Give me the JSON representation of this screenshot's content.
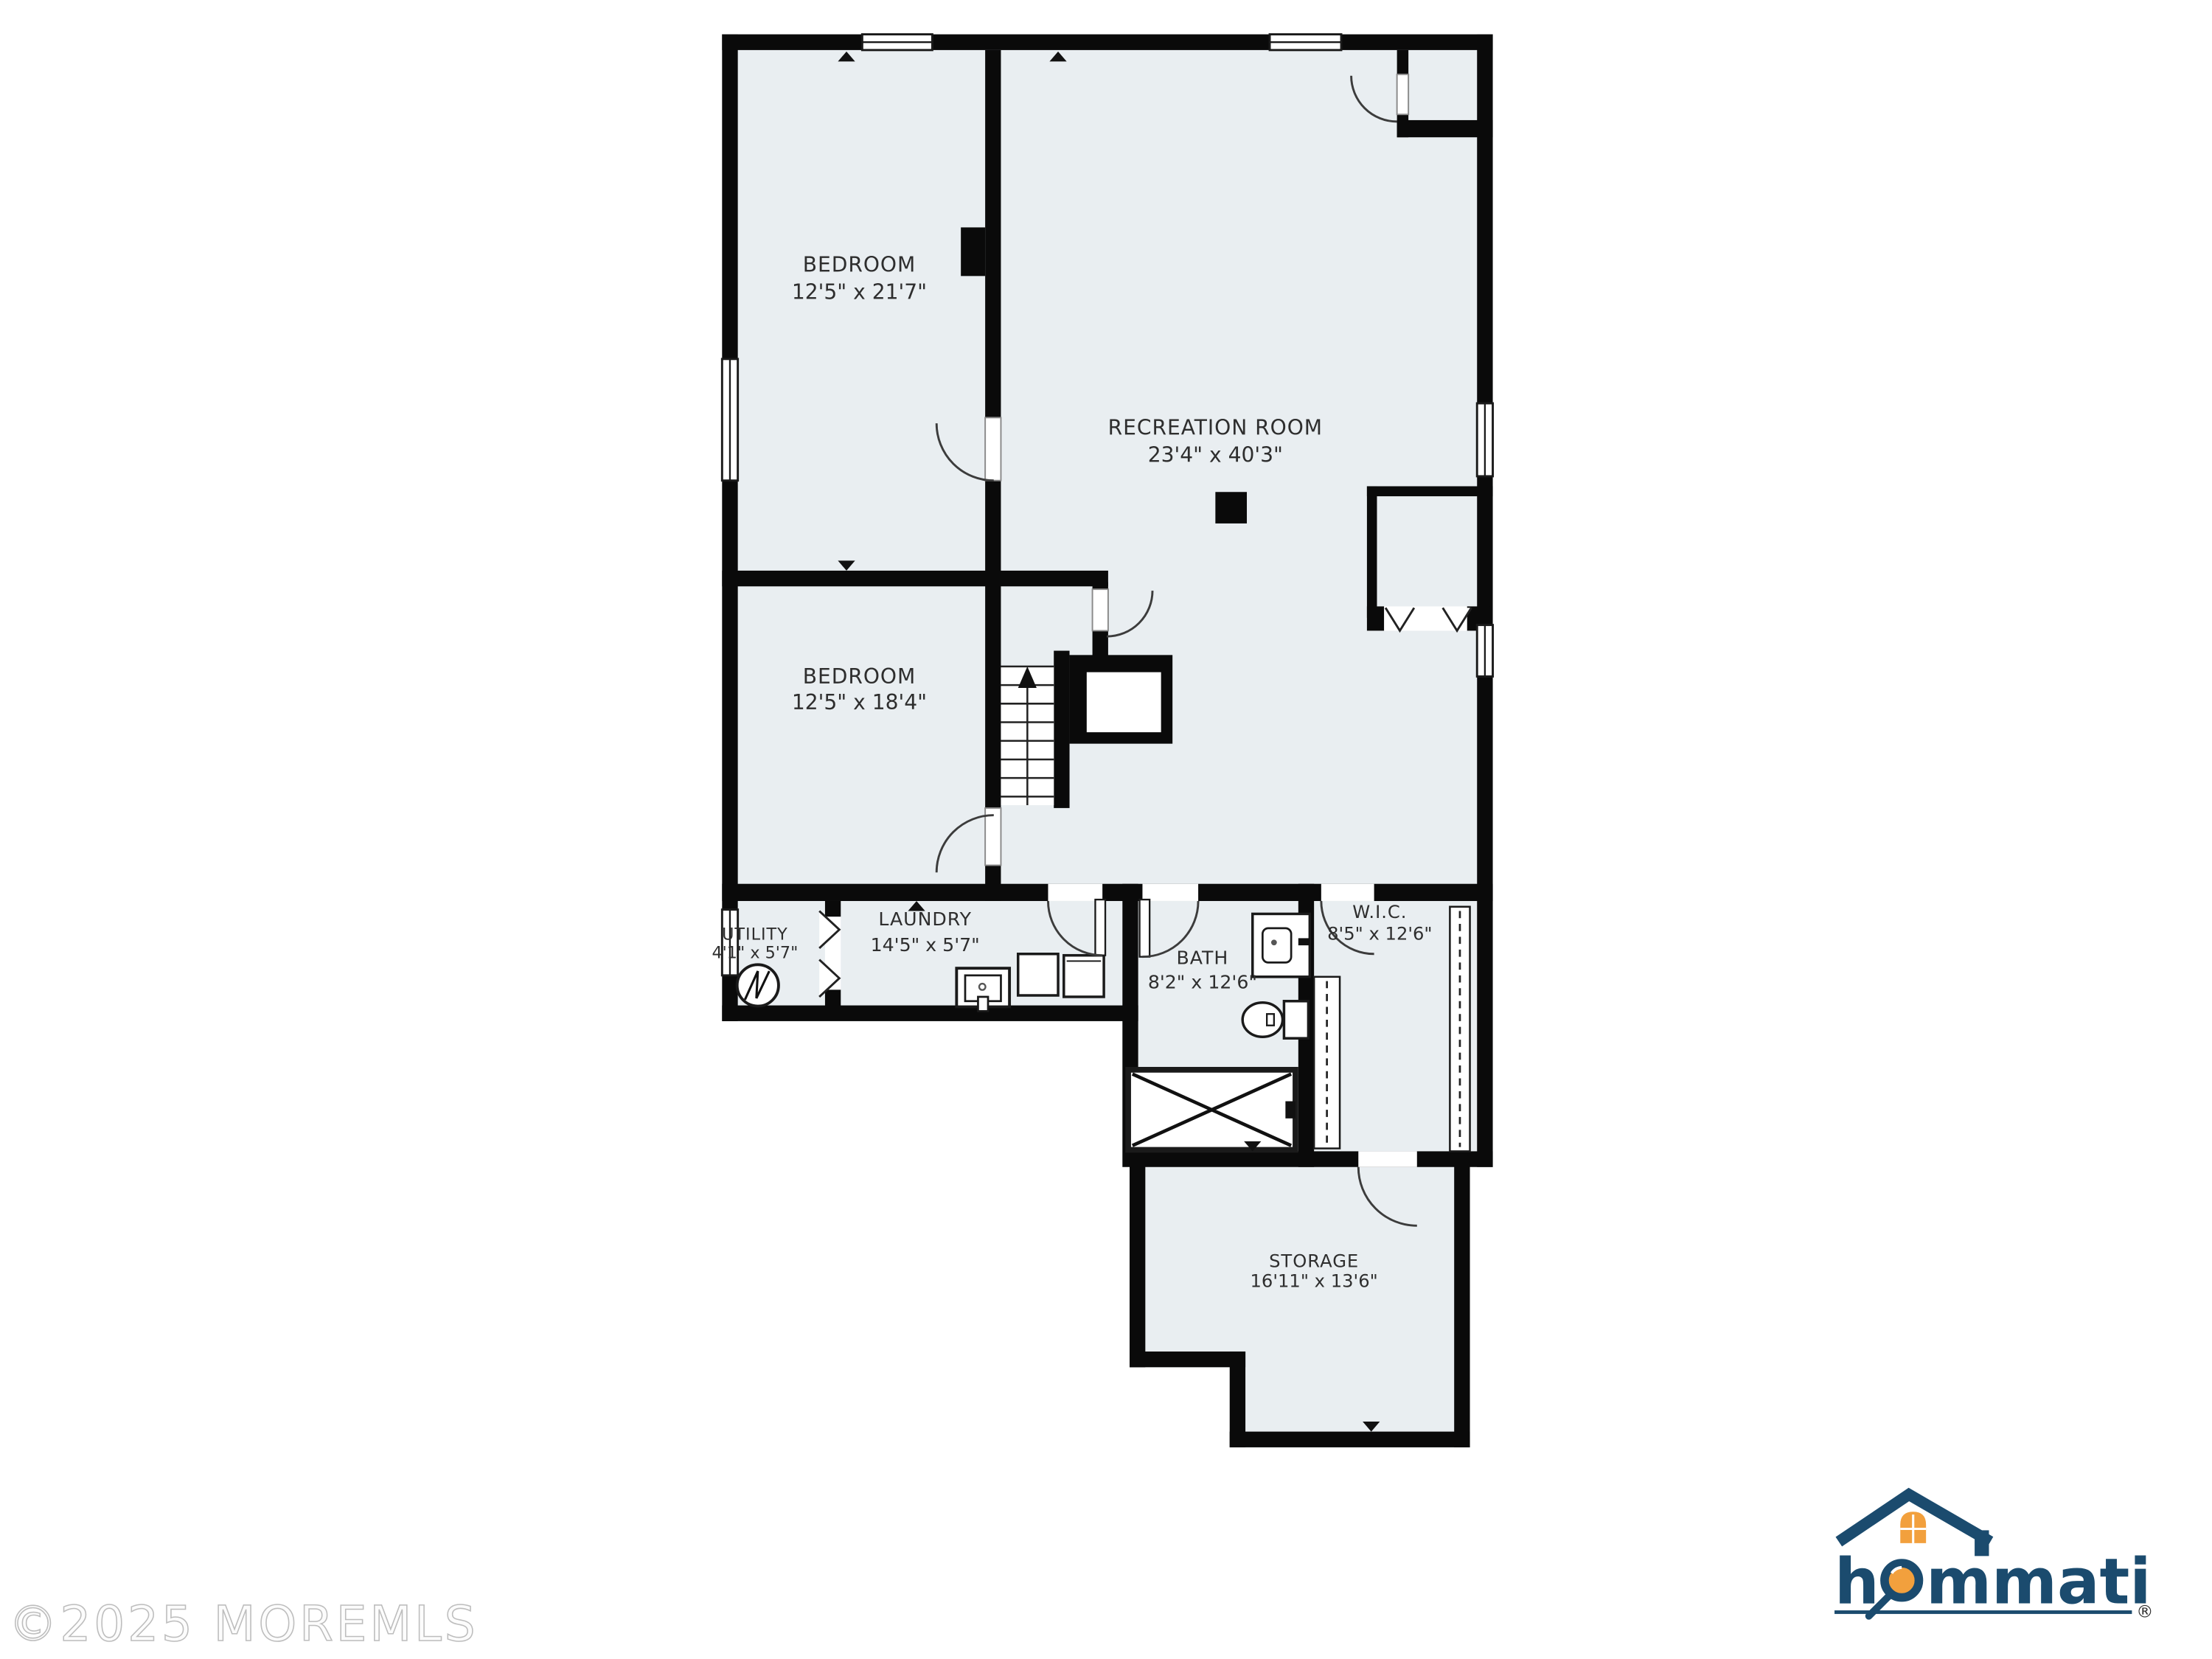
{
  "title": "Basement floor plan",
  "watermark": {
    "text": "©2025 MOREMLS"
  },
  "brand": {
    "name_first": "h",
    "name_rest": "mmati",
    "registered": "®",
    "navy": "#1b4b6e",
    "orange": "#f2a03d"
  },
  "colors": {
    "floor_fill": "#e9eef1",
    "wall": "#0a0a0a",
    "door_arc": "#3c3c3c",
    "background": "#ffffff"
  },
  "icons": {
    "stairs_up_arrow": "triangle-up",
    "water_heater": "circle-zigzag",
    "magnifier": "hommati-logo-o",
    "house_roof": "hommati-logo-roof"
  },
  "rooms": [
    {
      "id": "bedroom-1",
      "name": "BEDROOM",
      "dims": "12'5\" x 21'7\""
    },
    {
      "id": "recreation-room",
      "name": "RECREATION ROOM",
      "dims": "23'4\" x 40'3\""
    },
    {
      "id": "bedroom-2",
      "name": "BEDROOM",
      "dims": "12'5\" x 18'4\""
    },
    {
      "id": "utility",
      "name": "UTILITY",
      "dims": "4'1\" x 5'7\""
    },
    {
      "id": "laundry",
      "name": "LAUNDRY",
      "dims": "14'5\" x 5'7\""
    },
    {
      "id": "bath",
      "name": "BATH",
      "dims": "8'2\" x 12'6\""
    },
    {
      "id": "wic",
      "name": "W.I.C.",
      "dims": "8'5\" x 12'6\""
    },
    {
      "id": "storage",
      "name": "STORAGE",
      "dims": "16'11\" x 13'6\""
    }
  ]
}
